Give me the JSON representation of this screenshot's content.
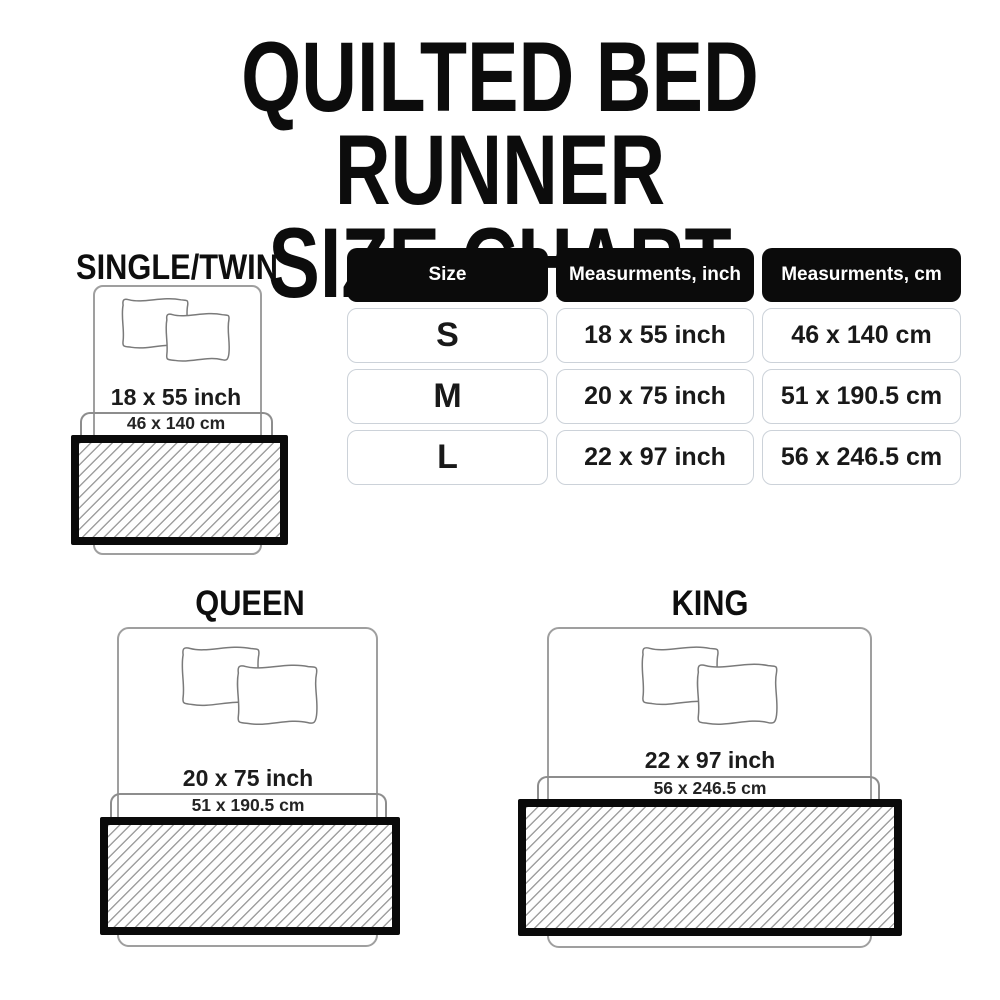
{
  "title": {
    "line1": "QUILTED BED RUNNER",
    "line2": "SIZE CHART"
  },
  "table": {
    "headers": {
      "size": "Size",
      "inch": "Measurments, inch",
      "cm": "Measurments, cm"
    },
    "rows": [
      {
        "size": "S",
        "inch": "18 x 55 inch",
        "cm": "46 x 140 cm"
      },
      {
        "size": "M",
        "inch": "20 x 75 inch",
        "cm": "51 x 190.5 cm"
      },
      {
        "size": "L",
        "inch": "22 x 97 inch",
        "cm": "56 x 246.5 cm"
      }
    ]
  },
  "diagrams": {
    "single": {
      "label": "SINGLE/TWIN",
      "inch": "18 x 55 inch",
      "cm": "46 x 140 cm"
    },
    "queen": {
      "label": "QUEEN",
      "inch": "20 x 75 inch",
      "cm": "51 x 190.5 cm"
    },
    "king": {
      "label": "KING",
      "inch": "22 x 97 inch",
      "cm": "56 x 246.5 cm"
    }
  },
  "colors": {
    "header_bg": "#0b0b0b",
    "header_text": "#ffffff",
    "runner_border": "#0a0a0a",
    "hatch_line": "#9f9f9f",
    "bed_outline": "#9f9f9f",
    "cell_border": "#ccd2d9",
    "text_dark": "#1c1c1c",
    "background": "#ffffff"
  }
}
